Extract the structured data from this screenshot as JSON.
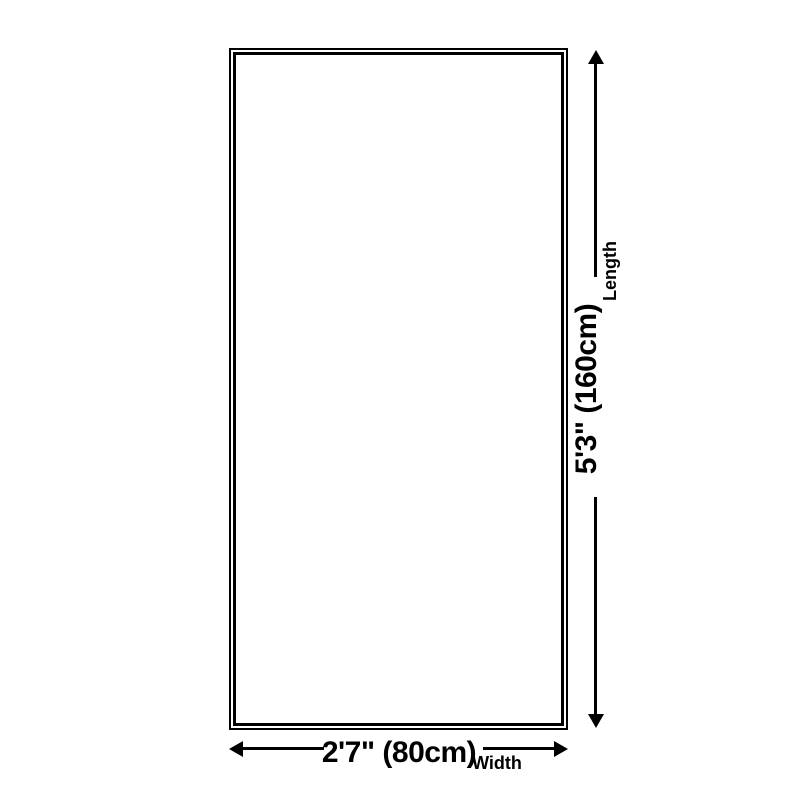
{
  "page": {
    "background_color": "#ffffff",
    "line_color": "#000000"
  },
  "diagram": {
    "shape": "rectangle",
    "length_dimension": {
      "value": "5'3\" (160cm)",
      "label": "Length"
    },
    "width_dimension": {
      "value": "2'7\" (80cm)",
      "label": "Width"
    }
  }
}
